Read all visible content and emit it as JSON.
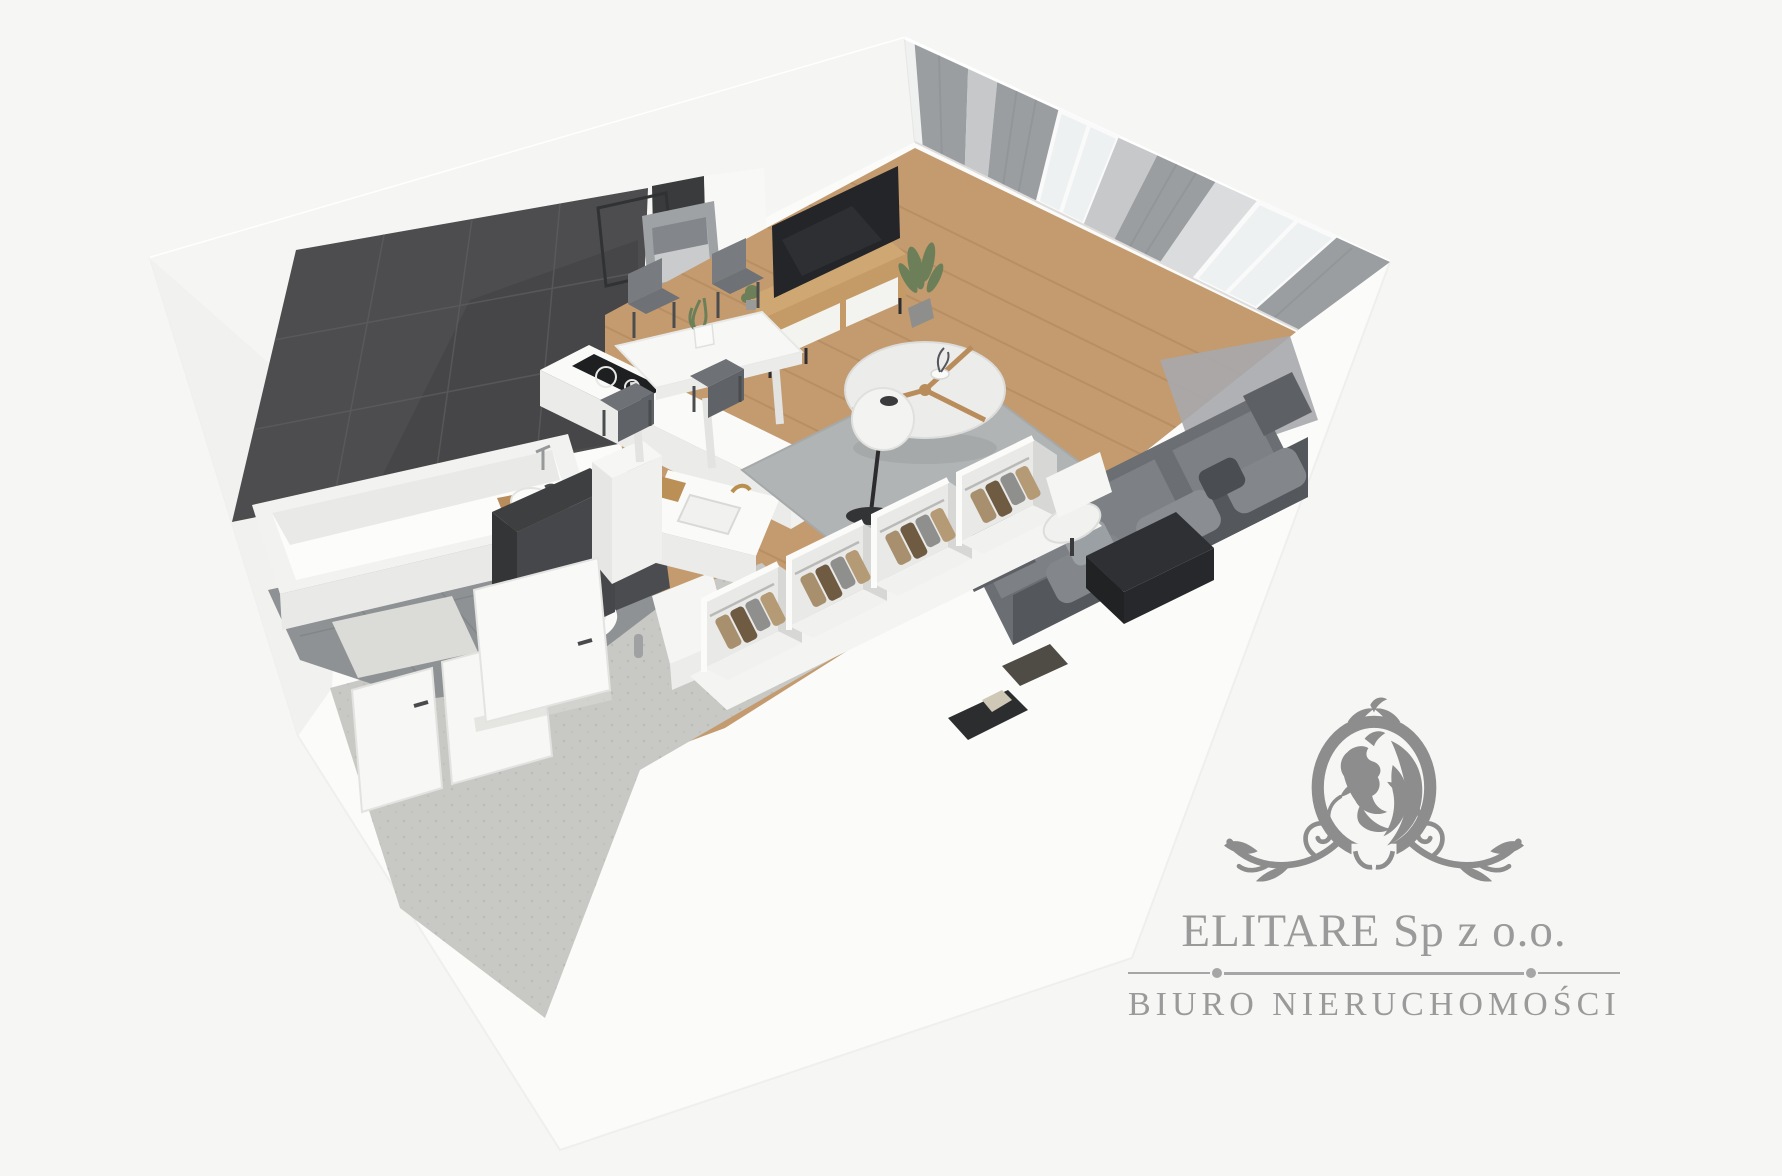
{
  "branding": {
    "company": "ELITARE Sp z o.o.",
    "tagline": "BIURO NIERUCHOMOŚCI",
    "logo_icon": "lion-crest-icon"
  },
  "scene": {
    "type": "3d-apartment-cutaway-floor-plan-render",
    "rooms": [
      {
        "name": "bathroom",
        "features": [
          "dark-tile-feature-wall",
          "bathtub",
          "washbasin-vanity",
          "wall-hung-toilet",
          "bath-mat",
          "gray-tile-floor",
          "washing-machine"
        ]
      },
      {
        "name": "hallway",
        "features": [
          "entrance-door",
          "open-interior-door",
          "terrazzo-floor",
          "doormats"
        ]
      },
      {
        "name": "kitchen",
        "features": [
          "white-counter",
          "induction-hob",
          "sink-with-brass-faucet",
          "cutting-board",
          "tall-dark-cabinet",
          "tall-white-cabinet"
        ]
      },
      {
        "name": "dining-area",
        "features": [
          "white-dining-table",
          "gray-chairs",
          "vase-with-plant"
        ]
      },
      {
        "name": "living-room",
        "features": [
          "gray-sofa",
          "round-coffee-table",
          "globe-floor-lamp",
          "tv",
          "wood-tv-sideboard",
          "potted-plant",
          "area-rug",
          "wood-plank-floor",
          "wall-art-frames",
          "gray-curtains",
          "window-wall",
          "balcony-door"
        ]
      },
      {
        "name": "wardrobe-area",
        "features": [
          "open-closet-units",
          "hanging-clothes",
          "desk",
          "desk-chair"
        ]
      }
    ]
  },
  "palette": {
    "bg": "#f6f6f4",
    "wall-ext": "#fbfbfa",
    "wall-face": "#f5f5f3",
    "wall-shade": "#f1f1ef",
    "tile-dark": "#4d4d4f",
    "tile-line": "#5c5c5e",
    "niche": "#3a3b3d",
    "bath-floor": "#8f9294",
    "bath-mat": "#dbdbd7",
    "terrazzo": "#c8c8c5",
    "wood": "#c39b6f",
    "wood-line": "#ab8156",
    "rug": "#b1b4b4",
    "curtain-dark": "#9b9ea1",
    "curtain-light": "#c6c8ca",
    "sheer": "#d8dadb",
    "glass": "#eef1f2",
    "sofa": "#6b6e72",
    "sofa-back": "#54575b",
    "sofa-cushion": "#7d8185",
    "tv": "#232528",
    "wood-furniture": "#c49a66",
    "white-furniture": "#f7f7f6",
    "chair": "#6e7175",
    "plant": "#6d7f58",
    "metal-dark": "#2c2c2e",
    "brass": "#b98f4e",
    "clothes-tan": "#a8906e",
    "clothes-brown": "#6f5a42",
    "clothes-gray": "#8f8f8d",
    "logo": "#8d8d8d",
    "logo-text": "#9a9a9a",
    "divider": "#a6a6a6"
  }
}
